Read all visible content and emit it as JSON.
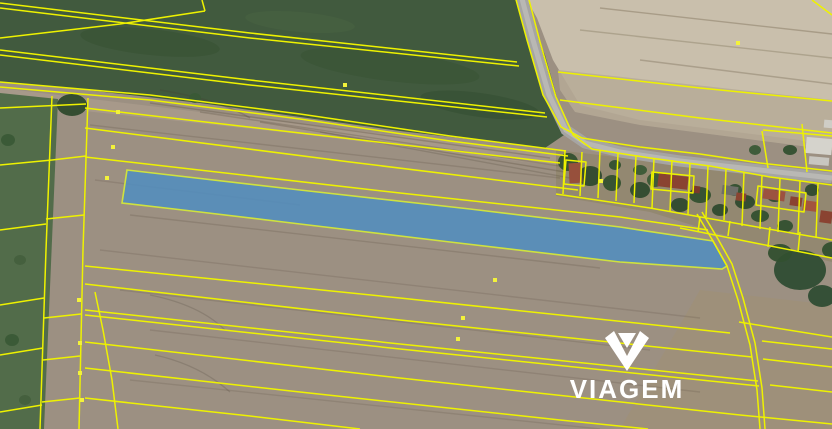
{
  "logo": {
    "text": "VIAGEM"
  },
  "colors": {
    "cadastral_line": "#eef200",
    "marker": "#f3f23a",
    "highlight_fill": "#528dbf",
    "highlight_stroke": "#cfe23e",
    "logo_color": "#ffffff"
  },
  "map": {
    "width": 832,
    "height": 429,
    "terrain": [
      {
        "name": "base-field",
        "rect": [
          0,
          0,
          832,
          429
        ],
        "fill": "#9c9082"
      },
      {
        "name": "track-band",
        "pts": "0,88 300,124 560,154 575,168 300,134 0,102",
        "fill": "#a89a8b",
        "opacity": 0.9
      },
      {
        "name": "bottom-right-field",
        "pts": "700,290 832,305 832,429 620,429",
        "fill": "#a29072",
        "opacity": 0.45
      },
      {
        "name": "tan-field",
        "pts": "527,0 832,0 832,150 800,140 640,120 580,105 553,60 537,18",
        "fill": "#c9bfac"
      },
      {
        "name": "tan-field-lower-strip",
        "pts": "558,70 832,100 832,150 640,125 575,112 560,90",
        "fill": "#b6aa96",
        "opacity": 0.85
      },
      {
        "name": "green-field",
        "pts": "0,0 523,0 545,55 567,133 545,148 400,131 200,103 60,87 0,82",
        "fill": "#415a3e"
      },
      {
        "name": "green-strip-left",
        "pts": "0,93 58,99 44,429 0,429",
        "fill": "#526c4a"
      },
      {
        "name": "village-band",
        "pts": "556,150 832,182 832,262 740,240 650,212 556,196",
        "fill": "#92876f",
        "opacity": 0.85
      }
    ],
    "green_patches": [
      {
        "cx": 150,
        "cy": 42,
        "rx": 70,
        "ry": 13,
        "rot": 6,
        "fill": "#35502f",
        "opacity": 0.5
      },
      {
        "cx": 390,
        "cy": 66,
        "rx": 90,
        "ry": 15,
        "rot": 7,
        "fill": "#35502f",
        "opacity": 0.4
      },
      {
        "cx": 300,
        "cy": 22,
        "rx": 55,
        "ry": 10,
        "rot": 5,
        "fill": "#4a6342",
        "opacity": 0.5
      },
      {
        "cx": 480,
        "cy": 105,
        "rx": 60,
        "ry": 12,
        "rot": 8,
        "fill": "#314b2e",
        "opacity": 0.45
      }
    ],
    "streaks": [
      {
        "pts": "150,103 550,158",
        "color": "rgba(70,60,45,0.25)"
      },
      {
        "pts": "200,112 560,166",
        "color": "rgba(70,60,45,0.22)"
      },
      {
        "pts": "260,122 565,172",
        "color": "rgba(70,60,45,0.25)"
      },
      {
        "pts": "320,132 570,178",
        "color": "rgba(70,60,45,0.2)"
      },
      {
        "pts": "90,125 560,178",
        "color": "rgba(75,63,48,0.18)"
      },
      {
        "pts": "95,180 300,205",
        "color": "rgba(75,63,48,0.16)"
      },
      {
        "pts": "130,215 600,268",
        "color": "rgba(75,63,48,0.18)"
      },
      {
        "pts": "100,250 700,318",
        "color": "rgba(75,63,48,0.16)"
      },
      {
        "pts": "120,290 650,350",
        "color": "rgba(75,63,48,0.17)"
      },
      {
        "pts": "150,330 700,392",
        "color": "rgba(75,63,48,0.16)"
      },
      {
        "pts": "130,380 600,429",
        "color": "rgba(75,63,48,0.15)"
      },
      {
        "pts": "600,8 832,34",
        "color": "rgba(140,128,105,0.55)"
      },
      {
        "pts": "580,30 832,58",
        "color": "rgba(140,128,105,0.45)"
      },
      {
        "pts": "640,60 832,84",
        "color": "rgba(140,128,105,0.5)"
      }
    ],
    "arcs": [
      {
        "d": "M150,295 Q200,305 225,330",
        "color": "rgba(70,60,48,0.2)"
      },
      {
        "d": "M155,355 Q200,365 230,392",
        "color": "rgba(70,60,48,0.2)"
      },
      {
        "d": "M160,90 Q220,100 250,118",
        "color": "rgba(70,60,48,0.25)"
      }
    ],
    "road": {
      "name": "road",
      "pts": "521,-5 533,40 549,95 566,130 585,143 620,152 680,161 760,170 832,178",
      "color": "#a6a5a2",
      "width": 11,
      "center_color": "#b9b8b4",
      "center_width": 5
    },
    "trees": [
      {
        "cx": 72,
        "cy": 105,
        "rx": 15,
        "ry": 11,
        "fill": "#2e4a2c"
      },
      {
        "cx": 195,
        "cy": 98,
        "rx": 6,
        "ry": 5,
        "fill": "#3a5a36"
      },
      {
        "cx": 8,
        "cy": 140,
        "rx": 7,
        "ry": 6,
        "fill": "#3a5a36"
      },
      {
        "cx": 20,
        "cy": 260,
        "rx": 6,
        "ry": 5,
        "fill": "#45603d"
      },
      {
        "cx": 12,
        "cy": 340,
        "rx": 7,
        "ry": 6,
        "fill": "#3a5a36"
      },
      {
        "cx": 25,
        "cy": 400,
        "rx": 6,
        "ry": 5,
        "fill": "#45603d"
      },
      {
        "cx": 568,
        "cy": 162,
        "rx": 10,
        "ry": 9,
        "fill": "#33502f"
      },
      {
        "cx": 590,
        "cy": 176,
        "rx": 12,
        "ry": 10,
        "fill": "#2f4a2e"
      },
      {
        "cx": 612,
        "cy": 183,
        "rx": 9,
        "ry": 8,
        "fill": "#33502f"
      },
      {
        "cx": 640,
        "cy": 190,
        "rx": 10,
        "ry": 8,
        "fill": "#2f4a2e"
      },
      {
        "cx": 655,
        "cy": 180,
        "rx": 8,
        "ry": 7,
        "fill": "#3a5a36"
      },
      {
        "cx": 615,
        "cy": 165,
        "rx": 6,
        "ry": 5,
        "fill": "#33502f"
      },
      {
        "cx": 640,
        "cy": 170,
        "rx": 7,
        "ry": 5,
        "fill": "#3a5a36"
      },
      {
        "cx": 680,
        "cy": 205,
        "rx": 9,
        "ry": 7,
        "fill": "#2f4a2e"
      },
      {
        "cx": 700,
        "cy": 195,
        "rx": 11,
        "ry": 8,
        "fill": "#33502f"
      },
      {
        "cx": 720,
        "cy": 210,
        "rx": 8,
        "ry": 6,
        "fill": "#2f4a2e"
      },
      {
        "cx": 735,
        "cy": 190,
        "rx": 7,
        "ry": 6,
        "fill": "#33502f"
      },
      {
        "cx": 745,
        "cy": 202,
        "rx": 10,
        "ry": 7,
        "fill": "#2f4a2e"
      },
      {
        "cx": 760,
        "cy": 216,
        "rx": 9,
        "ry": 6,
        "fill": "#33502f"
      },
      {
        "cx": 775,
        "cy": 196,
        "rx": 8,
        "ry": 6,
        "fill": "#2f4a2e"
      },
      {
        "cx": 785,
        "cy": 226,
        "rx": 8,
        "ry": 6,
        "fill": "#33502f"
      },
      {
        "cx": 812,
        "cy": 190,
        "rx": 7,
        "ry": 6,
        "fill": "#2f4a2e"
      },
      {
        "cx": 755,
        "cy": 150,
        "rx": 6,
        "ry": 5,
        "fill": "#3a5a36"
      },
      {
        "cx": 790,
        "cy": 150,
        "rx": 7,
        "ry": 5,
        "fill": "#33502f"
      },
      {
        "cx": 800,
        "cy": 270,
        "rx": 26,
        "ry": 20,
        "fill": "#2f4d33"
      },
      {
        "cx": 780,
        "cy": 253,
        "rx": 12,
        "ry": 9,
        "fill": "#33502f"
      },
      {
        "cx": 822,
        "cy": 296,
        "rx": 14,
        "ry": 11,
        "fill": "#2f4d33"
      },
      {
        "cx": 832,
        "cy": 250,
        "rx": 10,
        "ry": 8,
        "fill": "#33502f"
      }
    ],
    "houses": [
      {
        "x": 569,
        "y": 163,
        "w": 13,
        "h": 20,
        "fill": "#97503c",
        "rot": -3
      },
      {
        "x": 658,
        "y": 175,
        "w": 30,
        "h": 13,
        "fill": "#8a4331",
        "rot": 7
      },
      {
        "x": 692,
        "y": 186,
        "w": 8,
        "h": 7,
        "fill": "#7a3a2c",
        "rot": 7
      },
      {
        "x": 722,
        "y": 186,
        "w": 16,
        "h": 9,
        "fill": "#6e6e68",
        "rot": 8
      },
      {
        "x": 736,
        "y": 193,
        "w": 10,
        "h": 8,
        "fill": "#8a4331",
        "rot": 8
      },
      {
        "x": 763,
        "y": 190,
        "w": 22,
        "h": 10,
        "fill": "#9c5240",
        "rot": 8
      },
      {
        "x": 790,
        "y": 197,
        "w": 12,
        "h": 9,
        "fill": "#8a4331",
        "rot": 8
      },
      {
        "x": 803,
        "y": 201,
        "w": 14,
        "h": 10,
        "fill": "#a3543e",
        "rot": 8
      },
      {
        "x": 820,
        "y": 211,
        "w": 12,
        "h": 12,
        "fill": "#8a4331",
        "rot": 8
      },
      {
        "x": 806,
        "y": 138,
        "w": 26,
        "h": 16,
        "fill": "#d5d3cc",
        "rot": 5
      },
      {
        "x": 809,
        "y": 157,
        "w": 20,
        "h": 8,
        "fill": "#c8c6c0",
        "rot": 5
      },
      {
        "x": 824,
        "y": 120,
        "w": 10,
        "h": 8,
        "fill": "#cfcdc6",
        "rot": 5
      }
    ],
    "lines": [
      {
        "pts": "0,3 250,33 517,62"
      },
      {
        "pts": "0,8 250,38 519,66"
      },
      {
        "pts": "0,38 120,24 205,11"
      },
      {
        "pts": "205,11 202,0"
      },
      {
        "pts": "0,50 250,80 545,113"
      },
      {
        "pts": "0,55 250,85 547,117"
      },
      {
        "pts": "0,82 150,95 300,114 450,136 520,145 566,151"
      },
      {
        "pts": "0,87 150,100 300,119 450,141 522,150 568,156"
      },
      {
        "pts": "515,-4 527,40 543,95 561,127 582,138 640,147 700,154 760,163 832,171"
      },
      {
        "pts": "528,-4 540,42 556,97 573,135 592,149 650,158 710,166 770,177 832,185"
      },
      {
        "pts": "558,72 700,88 832,101"
      },
      {
        "pts": "560,100 700,118 832,133"
      },
      {
        "pts": "802,124 807,172"
      },
      {
        "pts": "763,130 832,136"
      },
      {
        "pts": "812,0 832,15"
      },
      {
        "pts": "85,108 300,133 560,163"
      },
      {
        "pts": "85,128 350,162 578,190"
      },
      {
        "pts": "85,157 400,193 620,217 708,230"
      },
      {
        "pts": "85,266 400,298 730,333"
      },
      {
        "pts": "762,341 832,349"
      },
      {
        "pts": "85,284 400,320 752,357"
      },
      {
        "pts": "763,359 832,367"
      },
      {
        "pts": "85,310 400,344 758,381"
      },
      {
        "pts": "85,315 400,349 759,386"
      },
      {
        "pts": "770,385 832,392"
      },
      {
        "pts": "85,342 400,378 740,415 832,424"
      },
      {
        "pts": "85,368 300,392 560,420 648,429"
      },
      {
        "pts": "85,398 250,416 360,429"
      },
      {
        "pts": "52,96 46,250 40,429"
      },
      {
        "pts": "88,98 83,250 79,429"
      },
      {
        "pts": "95,292 103,330 112,380 118,429"
      },
      {
        "pts": "46,219 84,215"
      },
      {
        "pts": "44,318 81,314"
      },
      {
        "pts": "43,360 80,356"
      },
      {
        "pts": "42,402 80,398"
      },
      {
        "pts": "0,108 86,104"
      },
      {
        "pts": "0,165 52,160 86,156"
      },
      {
        "pts": "0,230 46,224"
      },
      {
        "pts": "0,305 44,298"
      },
      {
        "pts": "0,355 43,348"
      },
      {
        "pts": "0,412 42,405"
      },
      {
        "pts": "556,194 650,208 740,224 832,240"
      },
      {
        "pts": "680,228 760,244 832,258"
      },
      {
        "pts": "565,150 563,194"
      },
      {
        "pts": "582,152 580,196"
      },
      {
        "pts": "600,150 598,198"
      },
      {
        "pts": "618,153 616,201"
      },
      {
        "pts": "636,155 634,203"
      },
      {
        "pts": "654,158 652,208"
      },
      {
        "pts": "672,160 670,211"
      },
      {
        "pts": "690,163 688,214"
      },
      {
        "pts": "708,166 706,217"
      },
      {
        "pts": "726,169 724,220"
      },
      {
        "pts": "744,172 742,226"
      },
      {
        "pts": "762,175 760,229"
      },
      {
        "pts": "780,178 778,232"
      },
      {
        "pts": "800,181 798,235"
      },
      {
        "pts": "818,184 816,238"
      },
      {
        "pts": "700,217 698,232"
      },
      {
        "pts": "730,221 728,236"
      },
      {
        "pts": "770,227 768,247"
      },
      {
        "pts": "800,232 798,252"
      },
      {
        "pts": "762,131 768,168"
      },
      {
        "pts": "697,214 713,241 727,266 738,300 750,345 757,390 760,429"
      },
      {
        "pts": "702,212 718,239 732,264 743,298 755,343 762,388 765,429"
      },
      {
        "pts": "739,322 832,337"
      },
      {
        "pts": "566,160 586,162 584,186 564,184",
        "closed": true
      },
      {
        "pts": "652,172 694,176 693,193 651,189",
        "closed": true
      },
      {
        "pts": "758,186 806,193 804,212 756,205",
        "closed": true
      }
    ],
    "highlight_parcel": {
      "name": "highlighted-parcel",
      "pts": "127,170 300,190 470,209 620,227 713,241 727,266 722,269 620,262 450,242 300,224 200,212 122,203",
      "fill": "#528dbf",
      "opacity": 0.87,
      "stroke": "#cfe23e",
      "stroke_width": 1.6
    },
    "markers": [
      [
        118,
        112
      ],
      [
        113,
        147
      ],
      [
        107,
        178
      ],
      [
        79,
        300
      ],
      [
        80,
        343
      ],
      [
        80,
        373
      ],
      [
        82,
        400
      ],
      [
        463,
        318
      ],
      [
        495,
        280
      ],
      [
        458,
        339
      ],
      [
        738,
        43
      ],
      [
        345,
        85
      ],
      [
        601,
        181
      ]
    ]
  }
}
